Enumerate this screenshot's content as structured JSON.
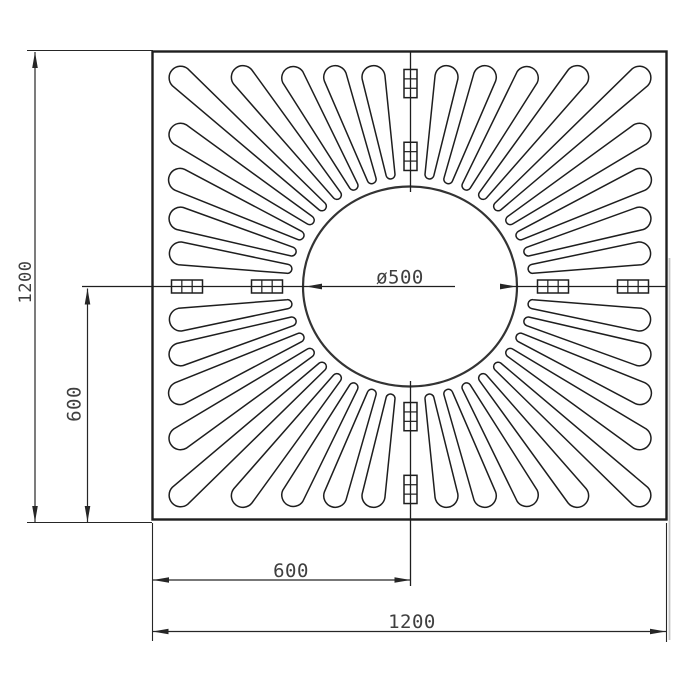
{
  "drawing": {
    "type": "technical-drawing",
    "subject": "square tree grate plan view with radial slots",
    "labels": {
      "left_overall": "1200",
      "left_half": "600",
      "bottom_half": "600",
      "bottom_overall": "1200",
      "hole_diameter": "ø500"
    },
    "colors": {
      "line": "#1e1e1e",
      "dim": "#262626",
      "text": "#3f3f3f",
      "background": "#ffffff",
      "shadow": "#c4c4c4"
    },
    "geometry": {
      "canvas": {
        "w": 690,
        "h": 690
      },
      "plate": {
        "x": 152.5,
        "y": 51.5,
        "w": 514,
        "h": 468
      },
      "center": {
        "x": 410,
        "y": 286.5
      },
      "y_scale": 0.91,
      "circle": {
        "rx": 107,
        "ry": 100
      },
      "slots": {
        "per_quadrant": 9,
        "step_deg": 9,
        "r_inner": 124,
        "r_outer_clear": 230,
        "cap_inner": 4.5,
        "cap_outer": 11.5
      },
      "tabs": {
        "axis_offsets": [
          143,
          223
        ],
        "length": 31,
        "width": 13
      }
    }
  }
}
